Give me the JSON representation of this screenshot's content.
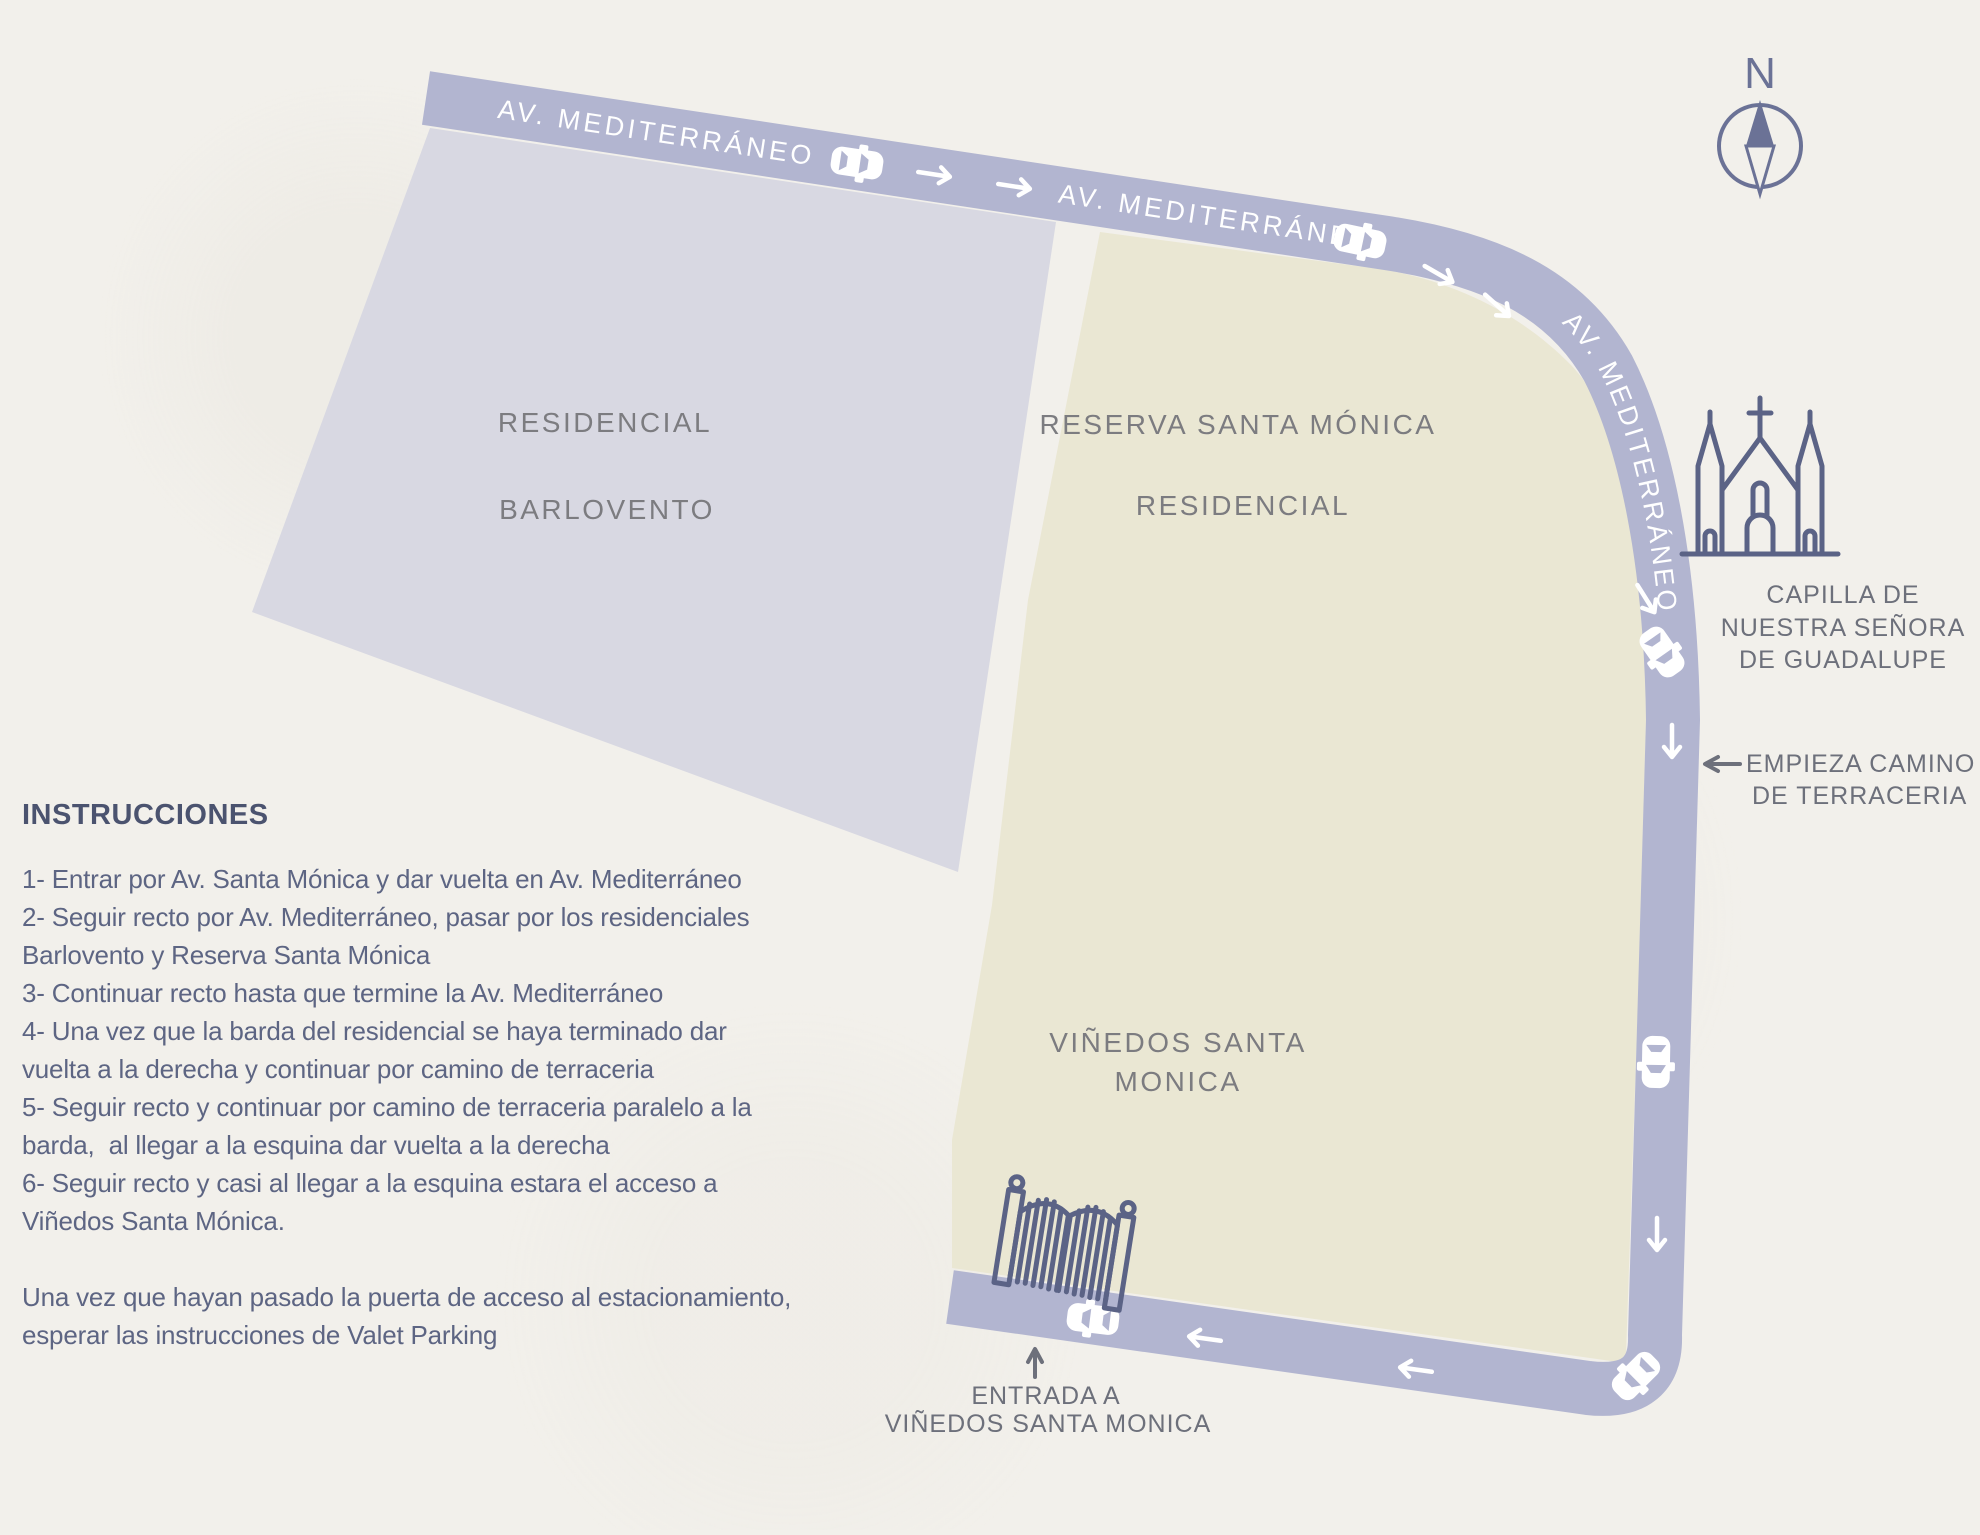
{
  "colors": {
    "paper": "#f2f0eb",
    "road": "#b2b5d0",
    "area_barlovento": "#d8d8e2",
    "area_reserva": "#eae7d3",
    "icon": "#5b6386",
    "caption": "#6d707b",
    "area_label": "#7c7c80",
    "heading": "#4b536f",
    "body": "#5d6583",
    "compass": "#6b7296",
    "car": "#ffffff"
  },
  "map": {
    "road_labels": [
      "AV. MEDITERRÁNEO",
      "AV. MEDITERRÁNEO",
      "AV. MEDITERRÁNEO"
    ],
    "areas": {
      "barlovento": {
        "line1": "RESIDENCIAL",
        "line2": "BARLOVENTO"
      },
      "reserva": {
        "line1": "RESERVA SANTA MÓNICA",
        "line2": "RESIDENCIAL"
      },
      "vinedos": {
        "line1": "VIÑEDOS SANTA",
        "line2": "MONICA"
      }
    },
    "compass": {
      "label": "N"
    },
    "church": {
      "caption": [
        "CAPILLA DE",
        "NUESTRA SEÑORA",
        "DE GUADALUPE"
      ]
    },
    "terraceria": {
      "caption": [
        "EMPIEZA CAMINO",
        "DE TERRACERIA"
      ]
    },
    "entrance": {
      "caption": [
        "ENTRADA A",
        "VIÑEDOS SANTA MONICA"
      ]
    }
  },
  "instructions": {
    "title": "INSTRUCCIONES",
    "lines": [
      "1- Entrar por Av. Santa Mónica y dar vuelta en Av. Mediterráneo",
      "2- Seguir recto por Av. Mediterráneo, pasar por los residenciales",
      "Barlovento y Reserva Santa Mónica",
      "3- Continuar recto hasta que termine la Av. Mediterráneo",
      "4- Una vez que la barda del residencial se haya terminado dar",
      "vuelta a la derecha y continuar por camino de terraceria",
      "5- Seguir recto y continuar por camino de terraceria paralelo a la",
      "barda,  al llegar a la esquina dar vuelta a la derecha",
      "6- Seguir recto y casi al llegar a la esquina estara el acceso a",
      "Viñedos Santa Mónica.",
      "",
      "Una vez que hayan pasado la puerta de acceso al estacionamiento,",
      "esperar las instrucciones de Valet Parking"
    ]
  }
}
